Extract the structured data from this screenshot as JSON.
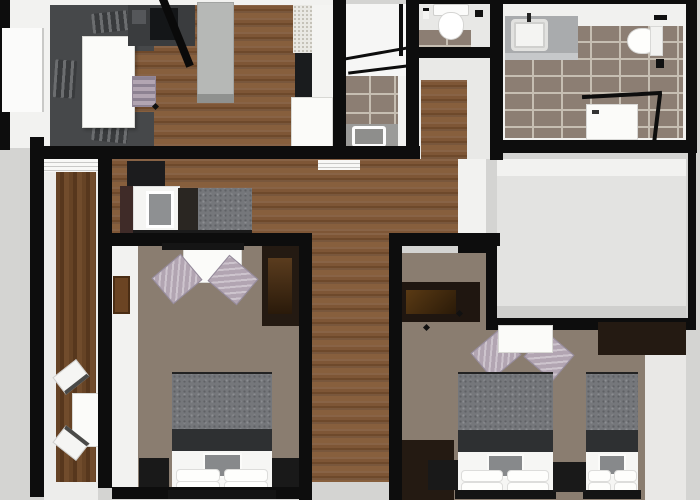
{
  "meta": {
    "title": "3D Apartment Floor Plan (top-down render)"
  },
  "palette": {
    "wall": "#0d0d0d",
    "exterior": "#d4d4d2",
    "white": "#f2f2f0",
    "wood": "#7e5636",
    "wood_dark": "#5e3d22",
    "tile": "#8c7e73",
    "grout": "#c6beb2",
    "carpet": "#8a7d70",
    "sofa": "#46484a",
    "table_white": "#fbfbf9",
    "lavender": "#b2a5b2",
    "bed_gray": "#75777b",
    "bed_band": "#2e3032",
    "furniture_black": "#191919",
    "wardrobe_brown": "#241a12",
    "gray_floor": "#e3e3e1"
  },
  "rooms": [
    {
      "id": "living-kitchen",
      "floor": "wood",
      "furniture": [
        "sectional-sofa",
        "coffee-table",
        "kitchen-counter",
        "kitchen-island",
        "bench",
        "fridge",
        "open-door"
      ]
    },
    {
      "id": "shower-room",
      "floor": "stone-tile",
      "furniture": [
        "glass-shower",
        "bath-mat"
      ]
    },
    {
      "id": "wc",
      "floor": "stone-tile",
      "furniture": [
        "toilet",
        "paper-holder"
      ]
    },
    {
      "id": "entry-hall",
      "floor": "wood",
      "furniture": []
    },
    {
      "id": "main-bathroom",
      "floor": "stone-tile",
      "furniture": [
        "vanity-sink",
        "toilet",
        "corner-shower"
      ]
    },
    {
      "id": "hallway-den",
      "floor": "wood",
      "furniture": [
        "single-bed",
        "black-cabinet"
      ]
    },
    {
      "id": "side-corridor",
      "floor": "wood",
      "furniture": [
        "dining-table",
        "chair",
        "chair"
      ]
    },
    {
      "id": "bedroom-left",
      "floor": "carpet",
      "furniture": [
        "double-bed",
        "nightstand",
        "nightstand",
        "desk",
        "chair",
        "chair",
        "wardrobe",
        "tv"
      ]
    },
    {
      "id": "bedroom-right",
      "floor": "carpet",
      "furniture": [
        "double-bed",
        "single-bed",
        "nightstand",
        "nightstand",
        "desk",
        "chair",
        "chair",
        "wardrobe",
        "dresser"
      ]
    },
    {
      "id": "empty-room",
      "floor": "gray",
      "furniture": []
    }
  ]
}
